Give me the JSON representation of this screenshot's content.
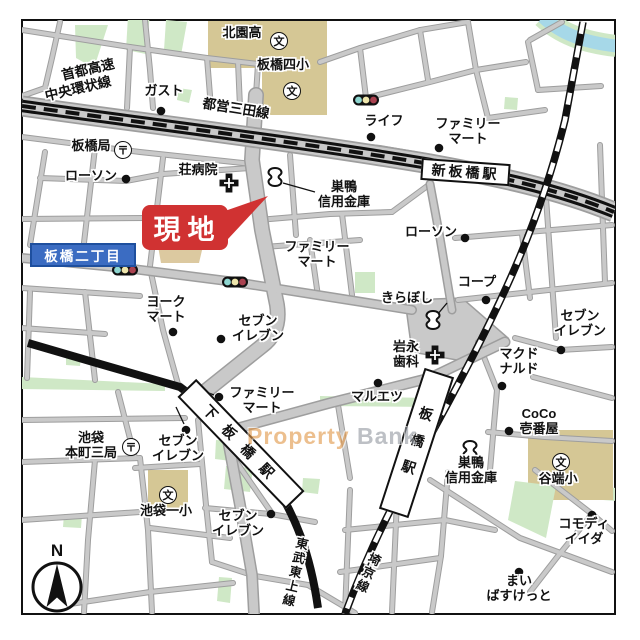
{
  "landmark": {
    "label": "現地"
  },
  "compass": {
    "label": "N"
  },
  "watermark": {
    "part1": "Property",
    "part2": "Bank"
  },
  "area_badge": {
    "label": "板橋二丁目"
  },
  "icons": {
    "school": "文",
    "post": "〒"
  },
  "lines": {
    "shuto1": "首都高速",
    "shuto2": "中央環状線",
    "mita": "都営三田線",
    "tobu": "東武東上線",
    "saikyo": "埼京線"
  },
  "stations": {
    "shin_itabashi": "新板橋駅",
    "shimo_itabashi": "下板橋駅",
    "itabashi": "板橋駅"
  },
  "pois": [
    {
      "label": "北園高"
    },
    {
      "label": "板橋四小"
    },
    {
      "label": "ガスト"
    },
    {
      "label": "ライフ"
    },
    {
      "label": "ファミリー\nマート"
    },
    {
      "label": "板橋局"
    },
    {
      "label": "ローソン"
    },
    {
      "label": "荘病院"
    },
    {
      "label": "巣鴨\n信用金庫"
    },
    {
      "label": "ファミリー\nマート"
    },
    {
      "label": "ローソン"
    },
    {
      "label": "コープ"
    },
    {
      "label": "きらぼし"
    },
    {
      "label": "ヨーク\nマート"
    },
    {
      "label": "セブン\nイレブン"
    },
    {
      "label": "岩永\n歯科"
    },
    {
      "label": "マクド\nナルド"
    },
    {
      "label": "セブン\nイレブン"
    },
    {
      "label": "マルエツ"
    },
    {
      "label": "CoCo\n壱番屋"
    },
    {
      "label": "巣鴨\n信用金庫"
    },
    {
      "label": "谷端小"
    },
    {
      "label": "コモディ\nイイダ"
    },
    {
      "label": "まい\nばすけっと"
    },
    {
      "label": "ファミリー\nマート"
    },
    {
      "label": "セブン\nイレブン"
    },
    {
      "label": "池袋\n本町三局"
    },
    {
      "label": "池袋一小"
    },
    {
      "label": "セブン\nイレブン"
    }
  ]
}
